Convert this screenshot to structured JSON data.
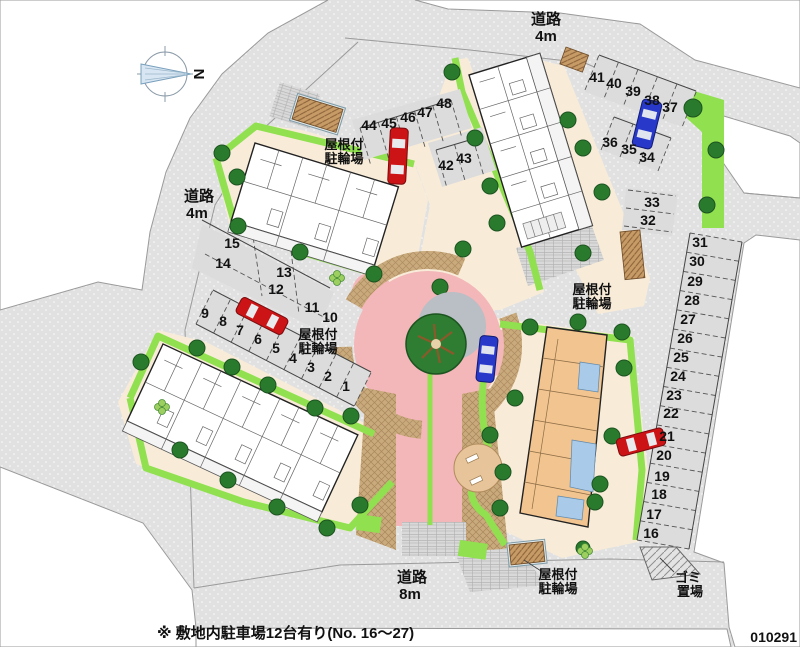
{
  "compass": {
    "letter": "N"
  },
  "labels": {
    "road": "道路",
    "four_m": "4m",
    "eight_m": "8m",
    "bike_1": "屋根付",
    "bike_2": "駐輪場",
    "garbage_1": "ゴミ",
    "garbage_2": "置場"
  },
  "note": "※ 敷地内駐車場12台有り(No. 16～27)",
  "plan_id": "010291",
  "stalls": [
    "1",
    "2",
    "3",
    "4",
    "5",
    "6",
    "7",
    "8",
    "9",
    "10",
    "11",
    "12",
    "13",
    "14",
    "15",
    "16",
    "17",
    "18",
    "19",
    "20",
    "21",
    "22",
    "23",
    "24",
    "25",
    "26",
    "27",
    "28",
    "29",
    "30",
    "31",
    "32",
    "33",
    "34",
    "35",
    "36",
    "37",
    "38",
    "39",
    "40",
    "41",
    "42",
    "43",
    "44",
    "45",
    "46",
    "47",
    "48"
  ],
  "colors": {
    "road_gray": "#e1e1e1",
    "site_beige": "#f8ecd9",
    "green_strip": "#90e050",
    "tree_green": "#2a7a2e",
    "plaza_pink": "#f3b6b9",
    "cobble_tan": "#c9aa7c",
    "car_red": "#cc1417",
    "car_blue": "#2838c8",
    "shed_brown": "#c79b66"
  }
}
